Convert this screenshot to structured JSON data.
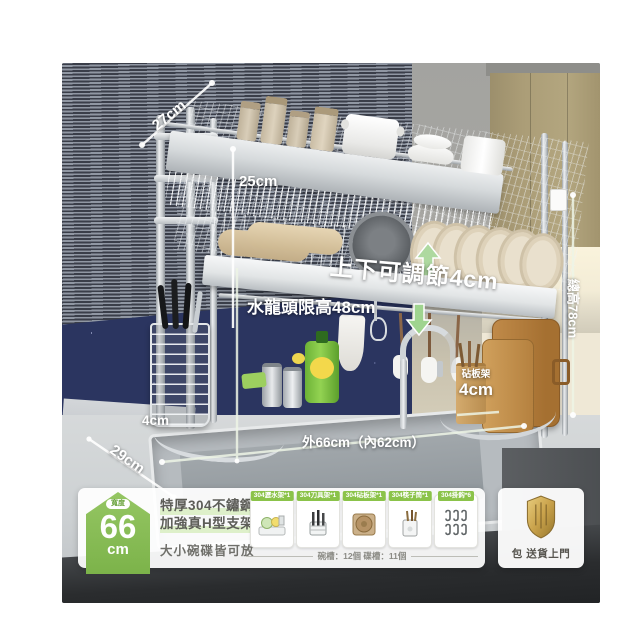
{
  "photo": {
    "annotations": {
      "top_depth": "27cm",
      "upper_gap": "25cm",
      "adjustable": "上下可調節4cm",
      "faucet_limit": "水龍頭限高48cm",
      "total_height": "總高78cm",
      "board_rack_name": "砧板架",
      "board_rack_size": "4cm",
      "basket_size": "4cm",
      "base_depth": "29cm",
      "outer_width": "外66cm（內62cm）"
    }
  },
  "info_bar": {
    "badge": {
      "top_label": "寬度",
      "value": "66",
      "unit": "cm"
    },
    "headline_line1": "特厚304不鏽鋼",
    "headline_line2": "加強真H型支架",
    "subline": "大小碗碟皆可放",
    "accessories": [
      {
        "label": "304瀝水架*1"
      },
      {
        "label": "304刀具架*1"
      },
      {
        "label": "304砧板架*1"
      },
      {
        "label": "304筷子筒*1"
      },
      {
        "label": "304掛鈎*6"
      }
    ],
    "slots_note": "碗槽：12個 碟槽：11個",
    "delivery_label": "包 送貨上門"
  }
}
